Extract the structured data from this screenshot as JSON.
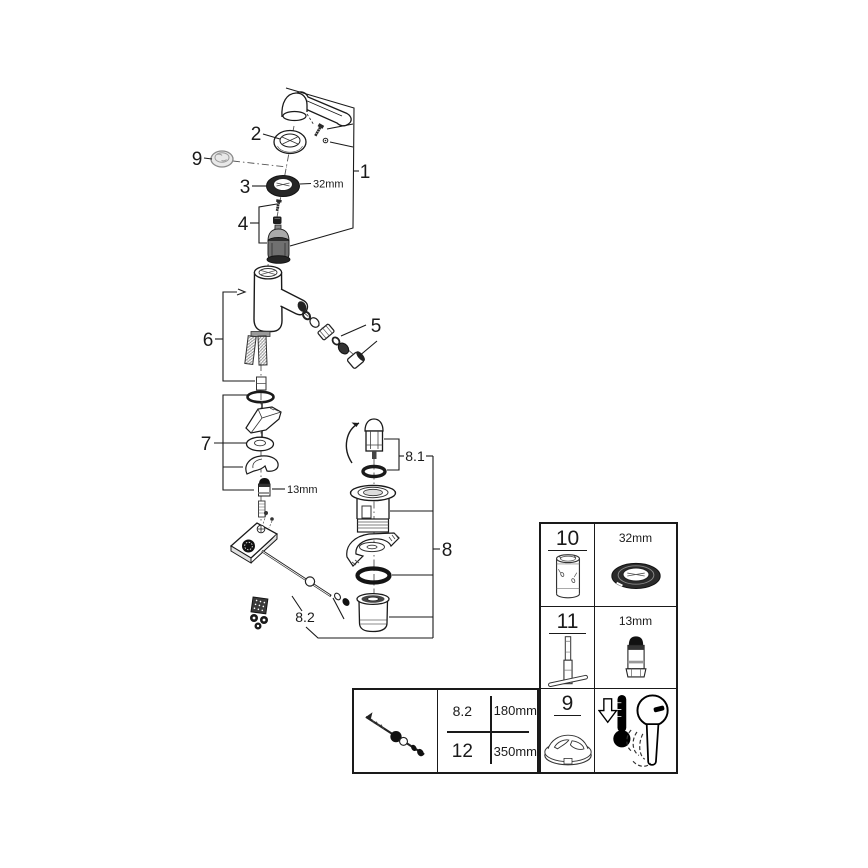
{
  "figure": {
    "title_hint": "exploded-parts-diagram",
    "callouts": {
      "n1": "1",
      "n2": "2",
      "n3": "3",
      "n4": "4",
      "n5": "5",
      "n6": "6",
      "n7": "7",
      "n8": "8",
      "n8_1": "8.1",
      "n8_2": "8.2",
      "n9": "9"
    },
    "dimensions": {
      "ring32": "32mm",
      "nut13": "13mm"
    }
  },
  "side_table": {
    "rows": [
      {
        "num": "10",
        "num_icon": "cartridge-sleeve-icon",
        "tool_label": "32mm",
        "tool_icon": "ring-nut-icon"
      },
      {
        "num": "11",
        "num_icon": "socket-tool-icon",
        "tool_label": "13mm",
        "tool_icon": "extension-nut-icon"
      },
      {
        "num": "9",
        "num_icon": "limiter-cap-icon",
        "tool_label": "",
        "tool_icon": "thermometer-lever-icon"
      }
    ]
  },
  "size_table": {
    "image_icon": "lift-rod-icon",
    "rows": [
      {
        "ref": "8.2",
        "value": "180mm"
      },
      {
        "ref": "12",
        "value": "350mm"
      }
    ]
  }
}
